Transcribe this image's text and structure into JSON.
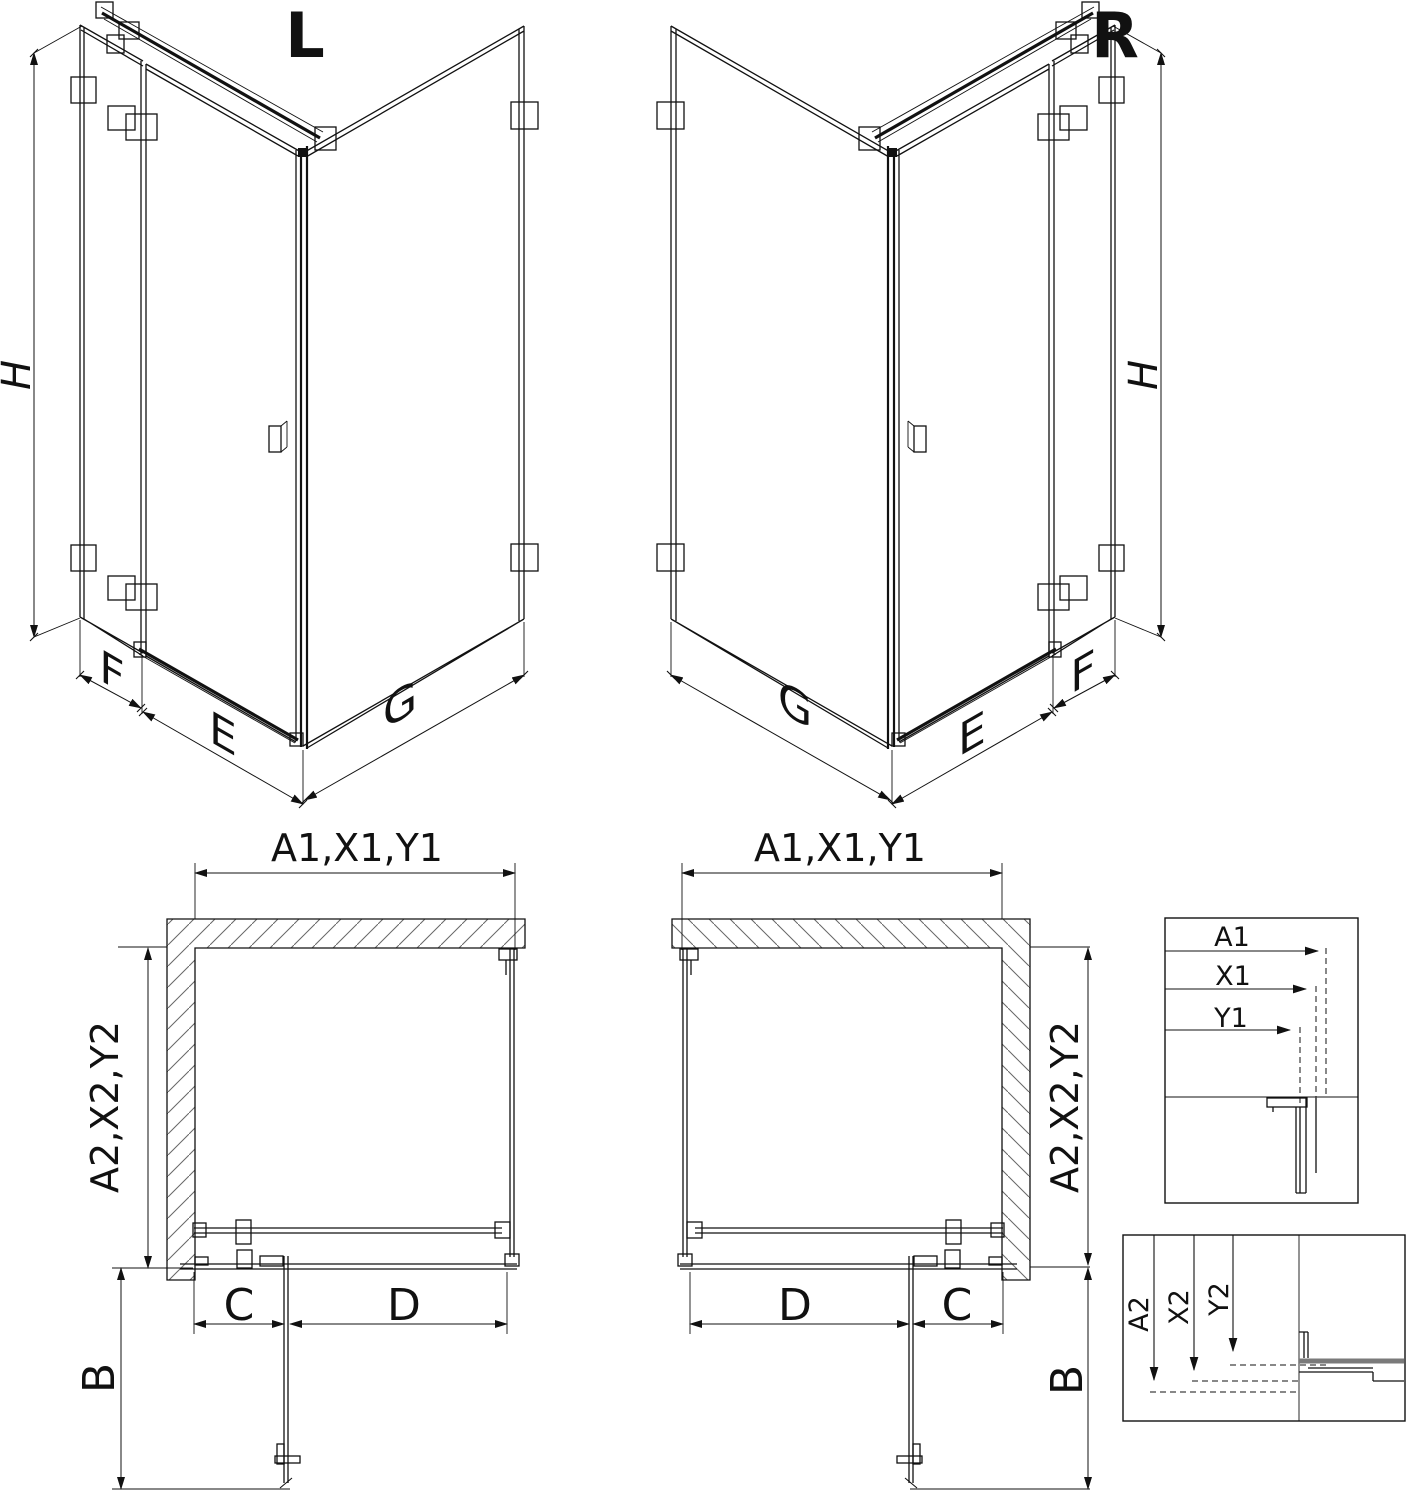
{
  "colors": {
    "line": "#111111",
    "hatch": "#666666",
    "profile_gray": "#7a7a7a",
    "background": "#ffffff"
  },
  "iso_views": {
    "left": {
      "variant_label": "L",
      "height_dim": "H",
      "side_panel_dim": "F",
      "door_dim": "E",
      "return_panel_dim": "G"
    },
    "right": {
      "variant_label": "R",
      "height_dim": "H",
      "side_panel_dim": "F",
      "door_dim": "E",
      "return_panel_dim": "G"
    }
  },
  "plan_views": {
    "left": {
      "width_dims": "A1,X1,Y1",
      "depth_dims": "A2,X2,Y2",
      "door_projection_dim": "B",
      "side_section_dim": "C",
      "door_section_dim": "D"
    },
    "right": {
      "width_dims": "A1,X1,Y1",
      "depth_dims": "A2,X2,Y2",
      "door_projection_dim": "B",
      "side_section_dim": "C",
      "door_section_dim": "D"
    }
  },
  "detail_views": {
    "width_detail": {
      "dim_a": "A1",
      "dim_x": "X1",
      "dim_y": "Y1"
    },
    "depth_detail": {
      "dim_a": "A2",
      "dim_x": "X2",
      "dim_y": "Y2"
    }
  }
}
